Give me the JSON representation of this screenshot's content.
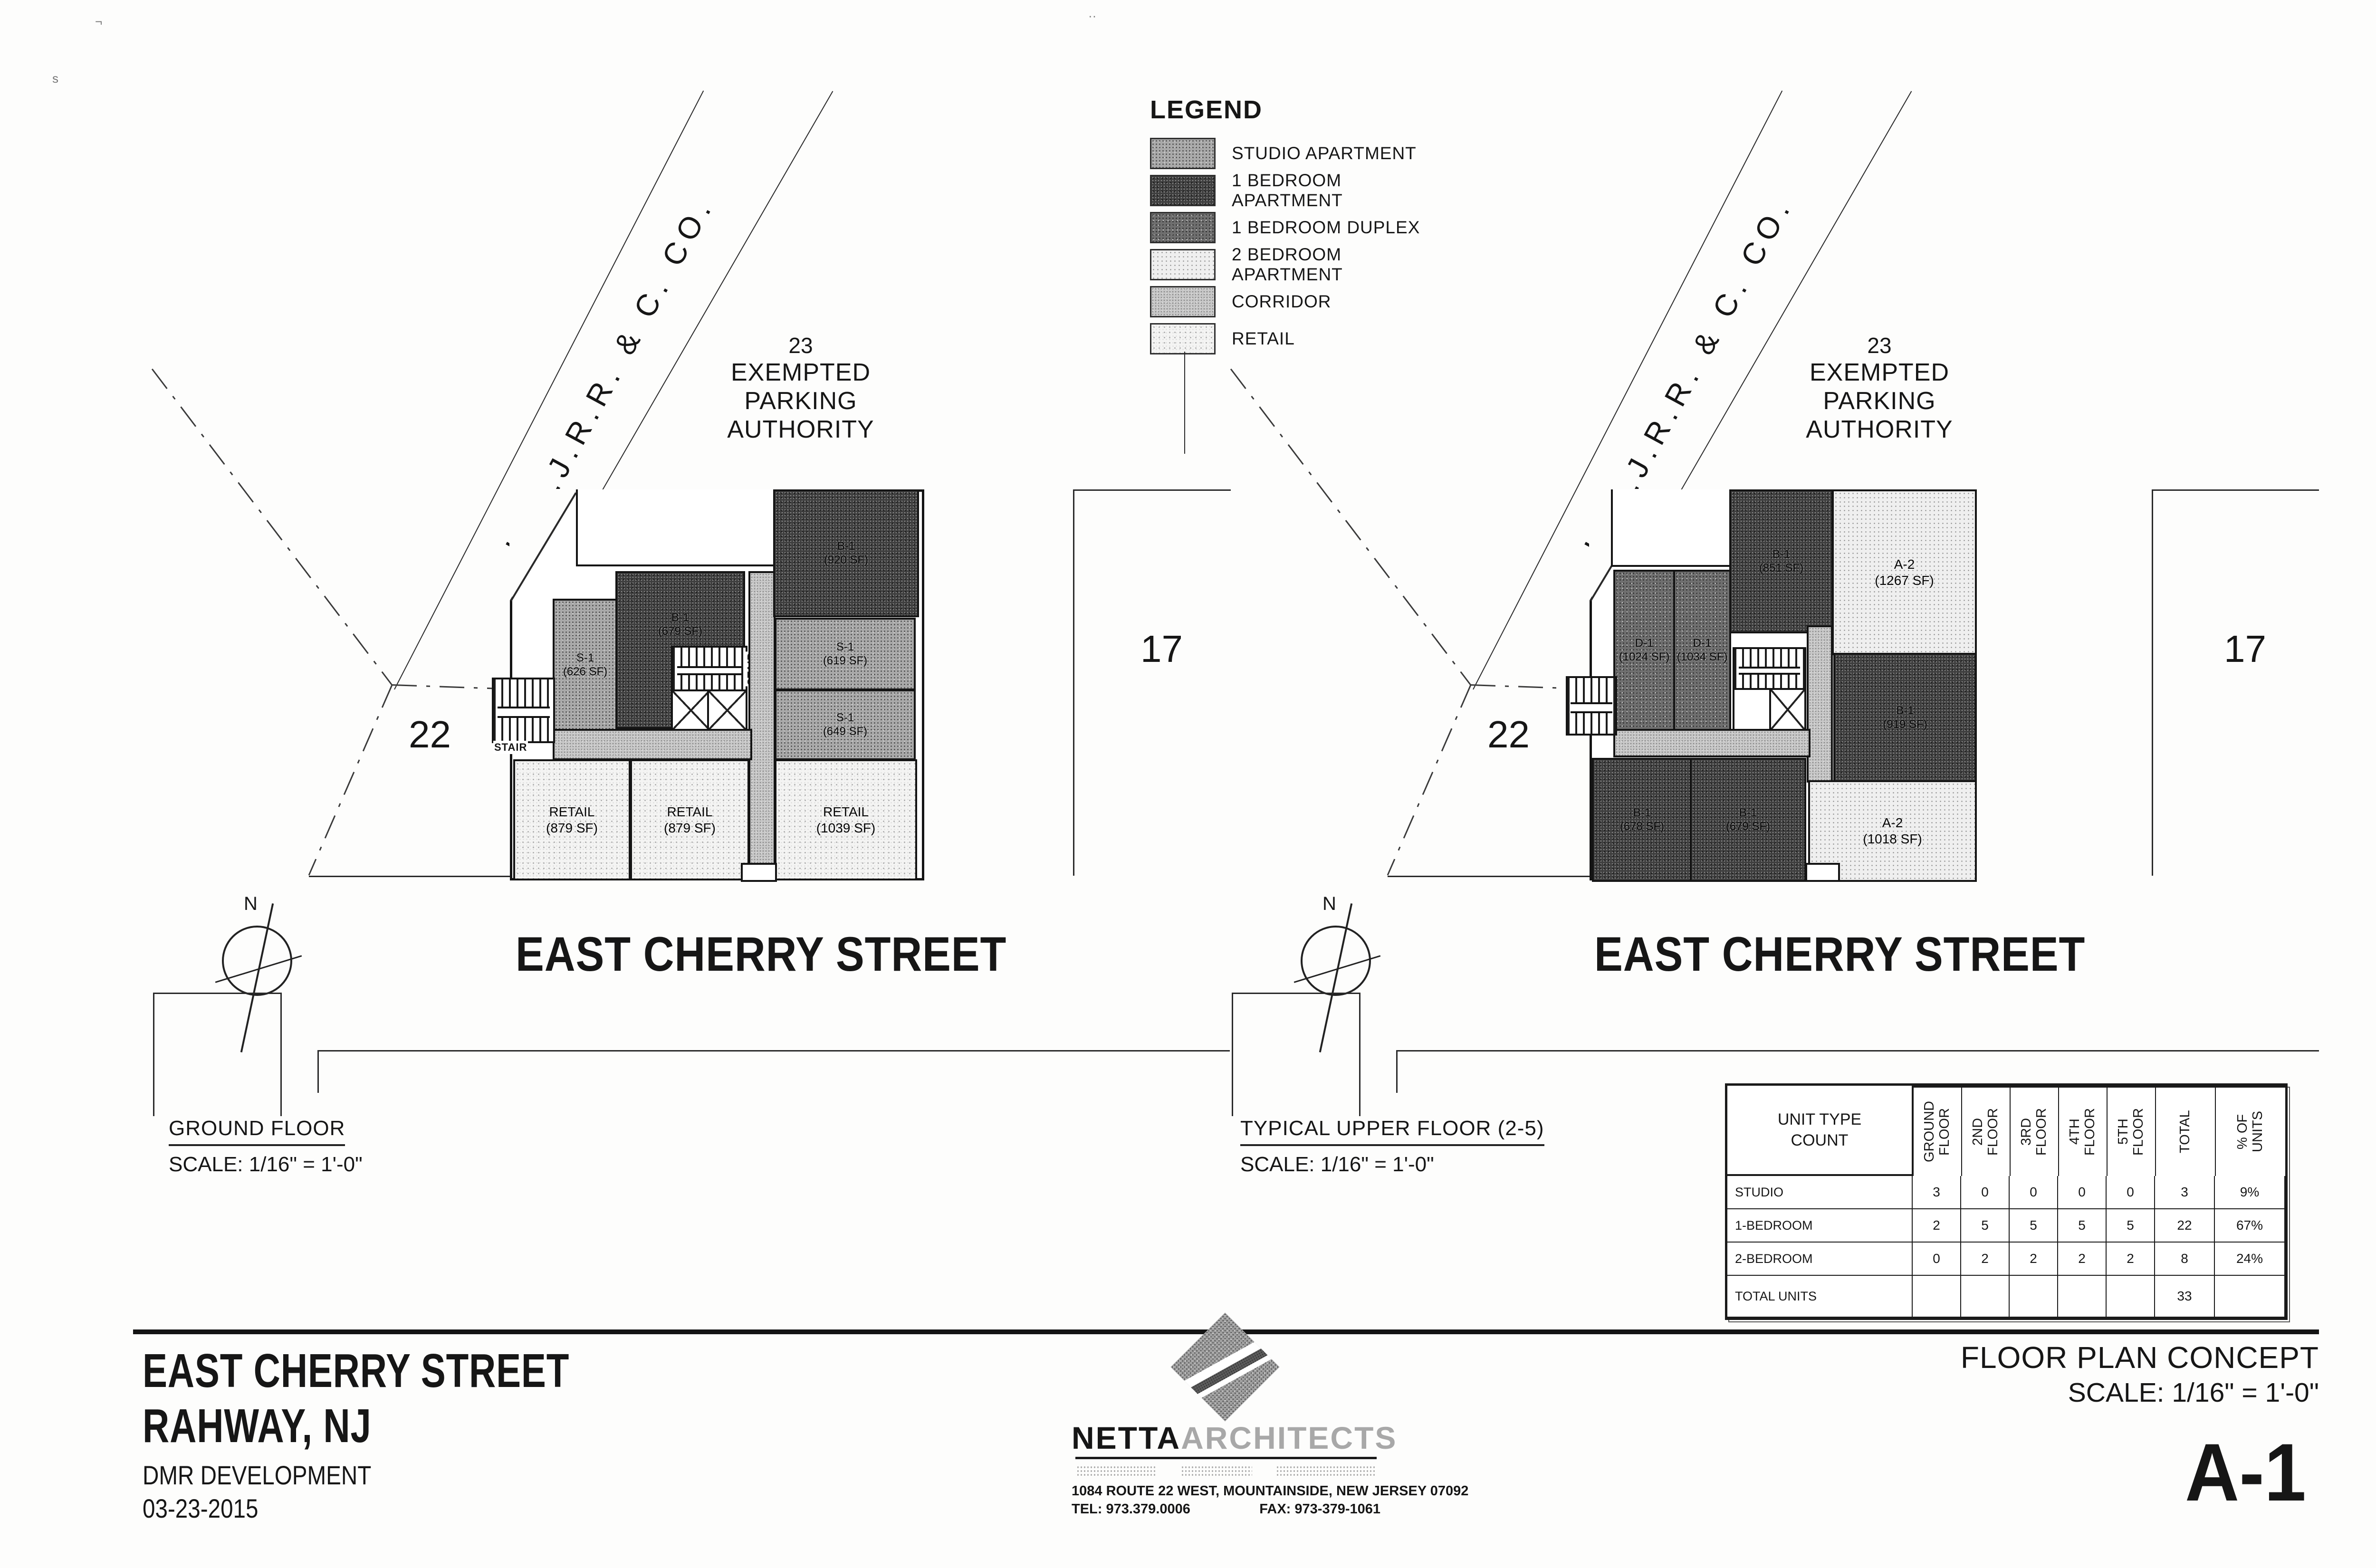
{
  "legend": {
    "title": "LEGEND",
    "items": [
      {
        "label": "STUDIO APARTMENT",
        "type": "studio"
      },
      {
        "label": "1 BEDROOM APARTMENT",
        "type": "one-bedroom-apartment"
      },
      {
        "label": "1 BEDROOM DUPLEX",
        "type": "one-bedroom-duplex"
      },
      {
        "label": "2 BEDROOM APARTMENT",
        "type": "two-bedroom-apartment"
      },
      {
        "label": "CORRIDOR",
        "type": "corridor"
      },
      {
        "label": "RETAIL",
        "type": "retail"
      }
    ]
  },
  "plans": {
    "ground": {
      "caption": "GROUND FLOOR",
      "scale": "SCALE: 1/16\" = 1'-0\"",
      "railroad": "U.N.J.R.R. & C. CO.",
      "parking": {
        "number": "23",
        "line1": "EXEMPTED",
        "line2": "PARKING AUTHORITY"
      },
      "street": "EAST CHERRY STREET",
      "parcel_left": "22",
      "parcel_right": "17",
      "north": "N",
      "stair": "STAIR",
      "units": {
        "s1a": {
          "code": "S-1",
          "area": "(626 SF)"
        },
        "b1a": {
          "code": "B-1",
          "area": "(679 SF)"
        },
        "b1b": {
          "code": "B-1",
          "area": "(920 SF)"
        },
        "s1b": {
          "code": "S-1",
          "area": "(619 SF)"
        },
        "s1c": {
          "code": "S-1",
          "area": "(649 SF)"
        },
        "retail1": {
          "code": "RETAIL",
          "area": "(879 SF)"
        },
        "retail2": {
          "code": "RETAIL",
          "area": "(879 SF)"
        },
        "retail3": {
          "code": "RETAIL",
          "area": "(1039 SF)"
        }
      }
    },
    "upper": {
      "caption": "TYPICAL UPPER FLOOR (2-5)",
      "scale": "SCALE: 1/16\" = 1'-0\"",
      "railroad": "U.N.J.R.R. & C. CO.",
      "parking": {
        "number": "23",
        "line1": "EXEMPTED",
        "line2": "PARKING AUTHORITY"
      },
      "street": "EAST CHERRY STREET",
      "parcel_left": "22",
      "parcel_right": "17",
      "north": "N",
      "units": {
        "d1a": {
          "code": "D-1",
          "area": "(1024 SF)"
        },
        "d1b": {
          "code": "D-1",
          "area": "(1034 SF)"
        },
        "b1a": {
          "code": "B-1",
          "area": "(851 SF)"
        },
        "a2a": {
          "code": "A-2",
          "area": "(1267 SF)"
        },
        "b1b": {
          "code": "B-1",
          "area": "(919 SF)"
        },
        "b1c": {
          "code": "B-1",
          "area": "(678 SF)"
        },
        "b1d": {
          "code": "B-1",
          "area": "(679 SF)"
        },
        "a2b": {
          "code": "A-2",
          "area": "(1018 SF)"
        }
      }
    }
  },
  "unit_table": {
    "title_line1": "UNIT TYPE",
    "title_line2": "COUNT",
    "columns": [
      "GROUND\nFLOOR",
      "2ND\nFLOOR",
      "3RD\nFLOOR",
      "4TH\nFLOOR",
      "5TH\nFLOOR",
      "TOTAL",
      "% OF\nUNITS"
    ],
    "rows": [
      {
        "label": "STUDIO",
        "values": [
          "3",
          "0",
          "0",
          "0",
          "0",
          "3",
          "9%"
        ]
      },
      {
        "label": "1-BEDROOM",
        "values": [
          "2",
          "5",
          "5",
          "5",
          "5",
          "22",
          "67%"
        ]
      },
      {
        "label": "2-BEDROOM",
        "values": [
          "0",
          "2",
          "2",
          "2",
          "2",
          "8",
          "24%"
        ]
      },
      {
        "label": "TOTAL UNITS",
        "values": [
          "",
          "",
          "",
          "",
          "",
          "33",
          ""
        ]
      }
    ]
  },
  "title_block": {
    "project_line1": "EAST CHERRY STREET",
    "project_line2": "RAHWAY, NJ",
    "client": "DMR DEVELOPMENT",
    "date": "03-23-2015",
    "drawing_title": "FLOOR PLAN CONCEPT",
    "drawing_scale": "SCALE: 1/16\" = 1'-0\"",
    "sheet_number": "A-1"
  },
  "architect": {
    "name_primary": "NETTA",
    "name_secondary": "ARCHITECTS",
    "address": "1084 ROUTE 22 WEST, MOUNTAINSIDE, NEW JERSEY 07092",
    "tel": "TEL: 973.379.0006",
    "fax": "FAX: 973-379-1061"
  }
}
